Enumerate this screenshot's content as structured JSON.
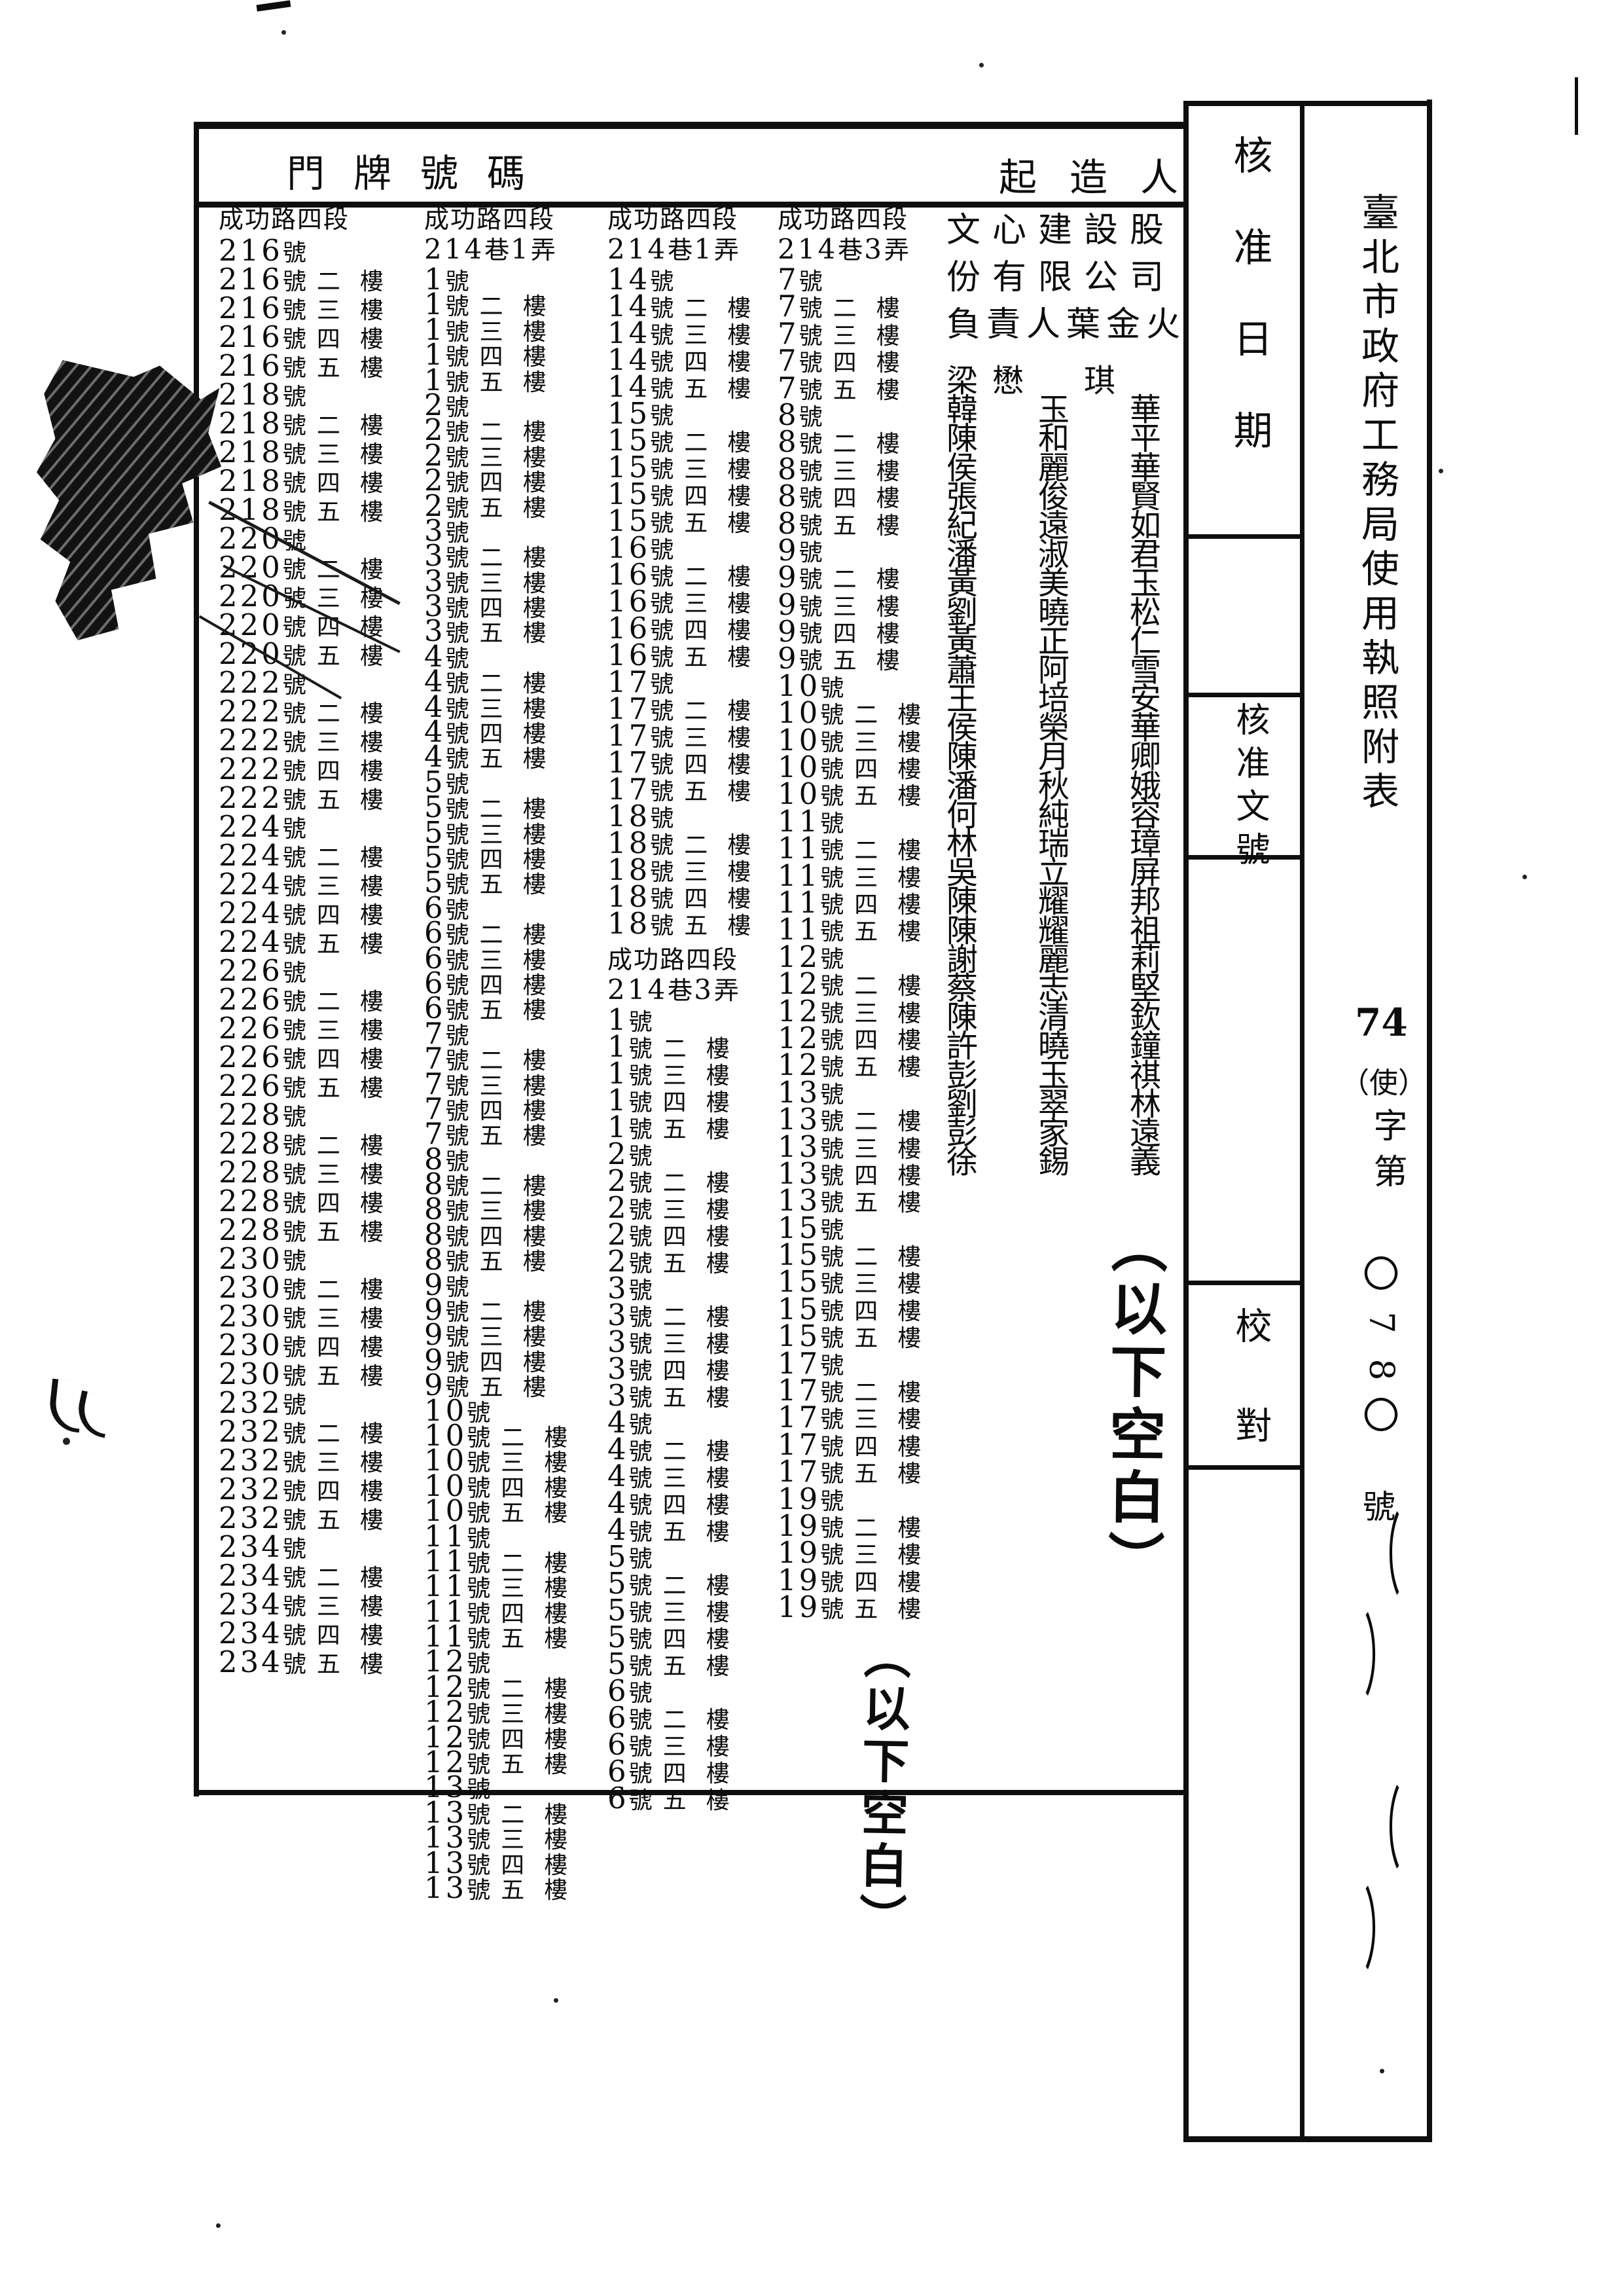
{
  "document": {
    "form_title_vertical": "臺北市政府工務局使用執照附表",
    "license_no": {
      "year": "74",
      "category": "（使）",
      "zi_di": "字第",
      "number": "0780",
      "hao": "號"
    },
    "header": {
      "address_label": "門牌號碼",
      "builder_label": "起造人"
    },
    "sidebar": {
      "approval_date_label": "核准日期",
      "approval_doc_label": "核准文號",
      "proofread_label": "校對"
    }
  },
  "address_columns": [
    {
      "headers": [
        "成功路四段"
      ],
      "entries": [
        "216號",
        "216號二樓",
        "216號三樓",
        "216號四樓",
        "216號五樓",
        "218號",
        "218號二樓",
        "218號三樓",
        "218號四樓",
        "218號五樓",
        "220號",
        "220號二樓",
        "220號三樓",
        "220號四樓",
        "220號五樓",
        "222號",
        "222號二樓",
        "222號三樓",
        "222號四樓",
        "222號五樓",
        "224號",
        "224號二樓",
        "224號三樓",
        "224號四樓",
        "224號五樓",
        "226號",
        "226號二樓",
        "226號三樓",
        "226號四樓",
        "226號五樓",
        "228號",
        "228號二樓",
        "228號三樓",
        "228號四樓",
        "228號五樓",
        "230號",
        "230號二樓",
        "230號三樓",
        "230號四樓",
        "230號五樓",
        "232號",
        "232號二樓",
        "232號三樓",
        "232號四樓",
        "232號五樓",
        "234號",
        "234號二樓",
        "234號三樓",
        "234號四樓",
        "234號五樓"
      ]
    },
    {
      "headers": [
        "成功路四段",
        "214巷1弄"
      ],
      "entries": [
        "1號",
        "1號二樓",
        "1號三樓",
        "1號四樓",
        "1號五樓",
        "2號",
        "2號二樓",
        "2號三樓",
        "2號四樓",
        "2號五樓",
        "3號",
        "3號二樓",
        "3號三樓",
        "3號四樓",
        "3號五樓",
        "4號",
        "4號二樓",
        "4號三樓",
        "4號四樓",
        "4號五樓",
        "5號",
        "5號二樓",
        "5號三樓",
        "5號四樓",
        "5號五樓",
        "6號",
        "6號二樓",
        "6號三樓",
        "6號四樓",
        "6號五樓",
        "7號",
        "7號二樓",
        "7號三樓",
        "7號四樓",
        "7號五樓",
        "8號",
        "8號二樓",
        "8號三樓",
        "8號四樓",
        "8號五樓",
        "9號",
        "9號二樓",
        "9號三樓",
        "9號四樓",
        "9號五樓",
        "10號",
        "10號二樓",
        "10號三樓",
        "10號四樓",
        "10號五樓",
        "11號",
        "11號二樓",
        "11號三樓",
        "11號四樓",
        "11號五樓",
        "12號",
        "12號二樓",
        "12號三樓",
        "12號四樓",
        "12號五樓",
        "13號",
        "13號二樓",
        "13號三樓",
        "13號四樓",
        "13號五樓"
      ]
    },
    {
      "headers": [
        "成功路四段",
        "214巷1弄"
      ],
      "entries": [
        "14號",
        "14號二樓",
        "14號三樓",
        "14號四樓",
        "14號五樓",
        "15號",
        "15號二樓",
        "15號三樓",
        "15號四樓",
        "15號五樓",
        "16號",
        "16號二樓",
        "16號三樓",
        "16號四樓",
        "16號五樓",
        "17號",
        "17號二樓",
        "17號三樓",
        "17號四樓",
        "17號五樓",
        "18號",
        "18號二樓",
        "18號三樓",
        "18號四樓",
        "18號五樓"
      ],
      "headers2": [
        "成功路四段",
        "214巷3弄"
      ],
      "entries2": [
        "1號",
        "1號二樓",
        "1號三樓",
        "1號四樓",
        "1號五樓",
        "2號",
        "2號二樓",
        "2號三樓",
        "2號四樓",
        "2號五樓",
        "3號",
        "3號二樓",
        "3號三樓",
        "3號四樓",
        "3號五樓",
        "4號",
        "4號二樓",
        "4號三樓",
        "4號四樓",
        "4號五樓",
        "5號",
        "5號二樓",
        "5號三樓",
        "5號四樓",
        "5號五樓",
        "6號",
        "6號二樓",
        "6號三樓",
        "6號四樓",
        "6號五樓"
      ]
    },
    {
      "headers": [
        "成功路四段",
        "214巷3弄"
      ],
      "entries": [
        "7號",
        "7號二樓",
        "7號三樓",
        "7號四樓",
        "7號五樓",
        "8號",
        "8號二樓",
        "8號三樓",
        "8號四樓",
        "8號五樓",
        "9號",
        "9號二樓",
        "9號三樓",
        "9號四樓",
        "9號五樓",
        "10號",
        "10號二樓",
        "10號三樓",
        "10號四樓",
        "10號五樓",
        "11號",
        "11號二樓",
        "11號三樓",
        "11號四樓",
        "11號五樓",
        "12號",
        "12號二樓",
        "12號三樓",
        "12號四樓",
        "12號五樓",
        "13號",
        "13號二樓",
        "13號三樓",
        "13號四樓",
        "13號五樓",
        "15號",
        "15號二樓",
        "15號三樓",
        "15號四樓",
        "15號五樓",
        "17號",
        "17號二樓",
        "17號三樓",
        "17號四樓",
        "17號五樓",
        "19號",
        "19號二樓",
        "19號三樓",
        "19號四樓",
        "19號五樓"
      ],
      "note": "（以下空白）"
    }
  ],
  "builders": {
    "company_line1": "文心建設股",
    "company_line2": "份有限公司",
    "principal_line": "負責人葉金火",
    "names": [
      "梁懋琪",
      "韓玉華",
      "陳和平",
      "侯麗華",
      "張俊賢",
      "紀遠如",
      "潘淑君",
      "黃美玉",
      "劉曉松",
      "黃正仁",
      "蕭阿雪",
      "王培安",
      "侯榮華",
      "陳月卿",
      "潘秋娥",
      "何純容",
      "林瑞璋",
      "吳立屏",
      "陳耀邦",
      "陳耀祖",
      "謝麗莉",
      "蔡志堅",
      "陳清欽",
      "許曉鐘",
      "彭玉祺",
      "劉翠林",
      "彭家遠",
      "徐錫義"
    ],
    "note": "（以下空白）"
  }
}
